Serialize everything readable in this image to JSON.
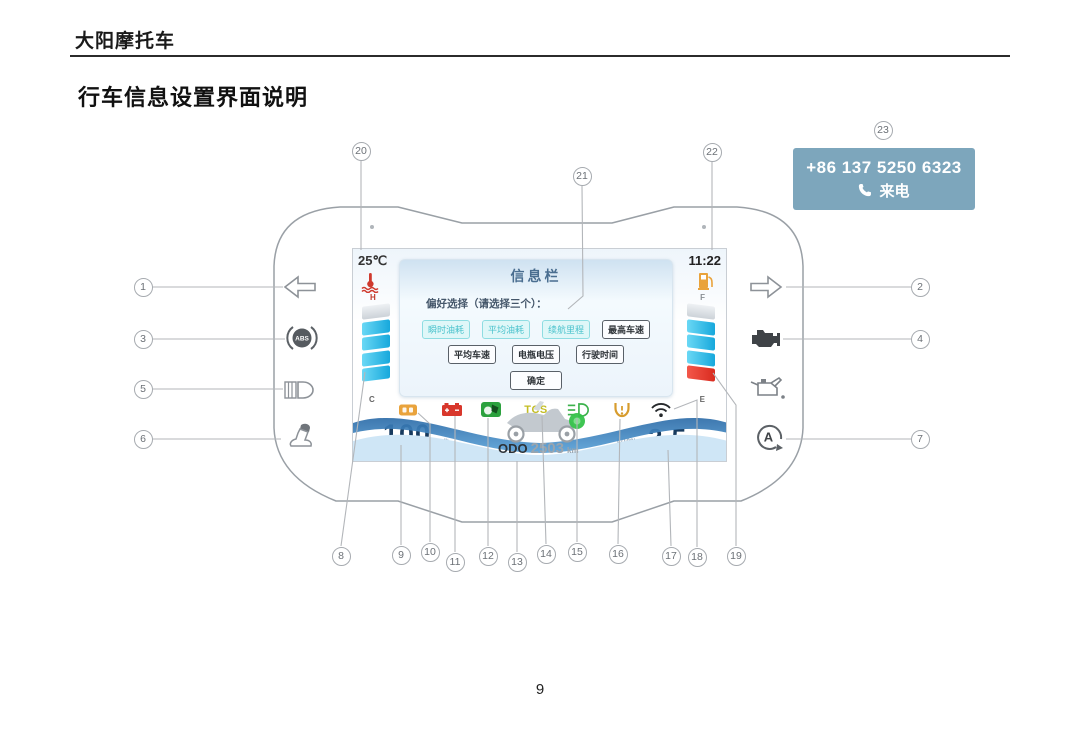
{
  "header": {
    "brand": "大阳摩托车",
    "title": "行车信息设置界面说明",
    "page_number": "9"
  },
  "call_box": {
    "phone": "+86 137 5250 6323",
    "label": "来电",
    "bg_color": "#7da6bc"
  },
  "callouts": [
    "1",
    "2",
    "3",
    "4",
    "5",
    "6",
    "7",
    "8",
    "9",
    "10",
    "11",
    "12",
    "13",
    "14",
    "15",
    "16",
    "17",
    "18",
    "19",
    "20",
    "21",
    "22",
    "23"
  ],
  "screen": {
    "ambient_temp": "25℃",
    "time": "11:22",
    "gauges": {
      "coolant": {
        "top": "H",
        "bottom": "C",
        "segments": [
          "empty",
          "fill",
          "fill",
          "fill",
          "fill"
        ]
      },
      "fuel": {
        "top": "F",
        "bottom": "E",
        "segments": [
          "empty",
          "fill",
          "fill",
          "fill",
          "red"
        ]
      }
    },
    "dialog": {
      "title": "信息栏",
      "prompt": "偏好选择（请选择三个）：",
      "row1": [
        {
          "label": "瞬时油耗",
          "selected": true
        },
        {
          "label": "平均油耗",
          "selected": true
        },
        {
          "label": "续航里程",
          "selected": true
        },
        {
          "label": "最高车速",
          "selected": false
        }
      ],
      "row2": [
        {
          "label": "平均车速",
          "selected": false
        },
        {
          "label": "电瓶电压",
          "selected": false
        },
        {
          "label": "行驶时间",
          "selected": false
        }
      ],
      "confirm": "确定"
    },
    "speed": "100",
    "speed_unit": "km/h",
    "tcs_label": "TCS",
    "odo_label": "ODO",
    "odo_value": "2503",
    "odo_unit": "km",
    "consumption": "2.5",
    "consumption_unit": "L/100km"
  },
  "colors": {
    "accent_teal": "#49c2cc",
    "gauge_cyan": "#2fb9e6",
    "alert_red": "#d92b1f",
    "navy": "#173a5e",
    "amber": "#e9a33c",
    "green": "#2ca13e",
    "callbox_blue": "#7da6bc"
  }
}
